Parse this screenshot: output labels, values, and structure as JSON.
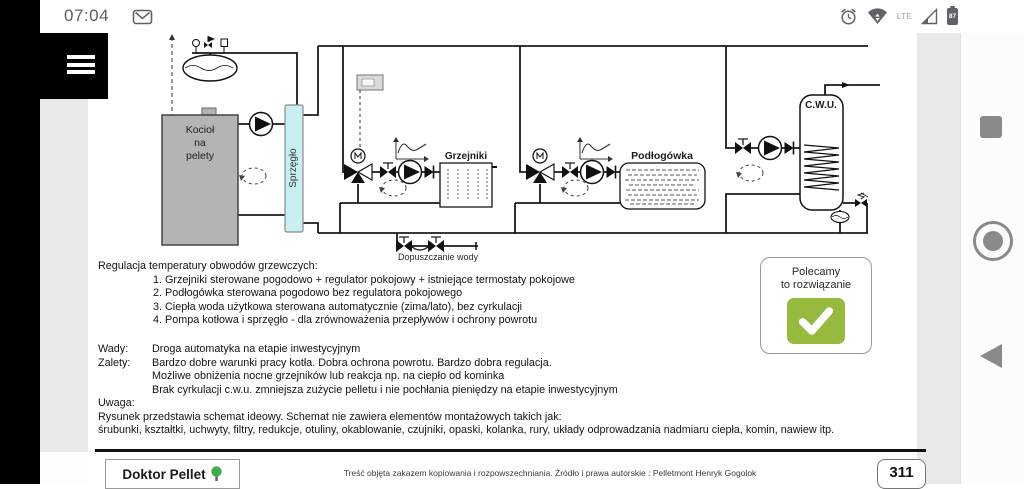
{
  "colors": {
    "recommend-green": "#96ba3e",
    "coupling-fill": "#c9eff0",
    "boiler-fill": "#b4b4b4",
    "tree-green": "#3fae49"
  },
  "status_bar": {
    "time": "07:04",
    "network": "LTE",
    "battery_percent": "87"
  },
  "document": {
    "diagram": {
      "boiler_label": "Kocioł\nna\npelety",
      "coupling_label": "Sprzęgło",
      "radiators_label": "Grzejniki",
      "floor_heating_label": "Podłogówka",
      "dhw_label": "C.W.U.",
      "water_fill_label": "Dopuszczanie wody"
    },
    "regulation": {
      "title": "Regulacja temperatury obwodów grzewczych:",
      "items": [
        "1. Grzejniki sterowane pogodowo + regulator pokojowy + istniejące termostaty pokojowe",
        "2. Podłogówka sterowana pogodowo bez regulatora pokojowego",
        "3. Ciepła woda użytkowa sterowana automatycznie (zima/lato), bez cyrkulacji",
        "4. Pompa kotłowa i sprzęgło - dla zrównoważenia przepływów i ochrony powrotu"
      ]
    },
    "cons_label": "Wady:",
    "cons_text": "Droga automatyka na etapie inwestycyjnym",
    "pros_label": "Zalety:",
    "pros_lines": [
      "Bardzo dobre warunki pracy kotła. Dobra ochrona powrotu. Bardzo dobra regulacja.",
      "Możliwe obniżenia nocne grzejników lub reakcja np. na ciepło od kominka",
      "Brak cyrkulacji c.w.u. zmniejsza zużycie pelletu i nie pochłania pieniędzy na etapie inwestycyjnym"
    ],
    "note_label": "Uwaga:",
    "note_lines": [
      "Rysunek przedstawia schemat ideowy. Schemat nie zawiera elementów montażowych takich jak:",
      "śrubunki, kształtki, uchwyty, filtry, redukcje, otuliny, okablowanie, czujniki, opaski, kolanka, rury, układy odprowadzania nadmiaru ciepła, komin, nawiew itp."
    ],
    "recommendation": "Polecamy\nto rozwiązanie",
    "footer": {
      "brand": "Doktor Pellet",
      "copyright": "Treść objęta zakazem kopiowania i rozpowszechniania. Źródło i prawa autorskie : Pelletmont Henryk Gogolok",
      "page": "311"
    }
  }
}
